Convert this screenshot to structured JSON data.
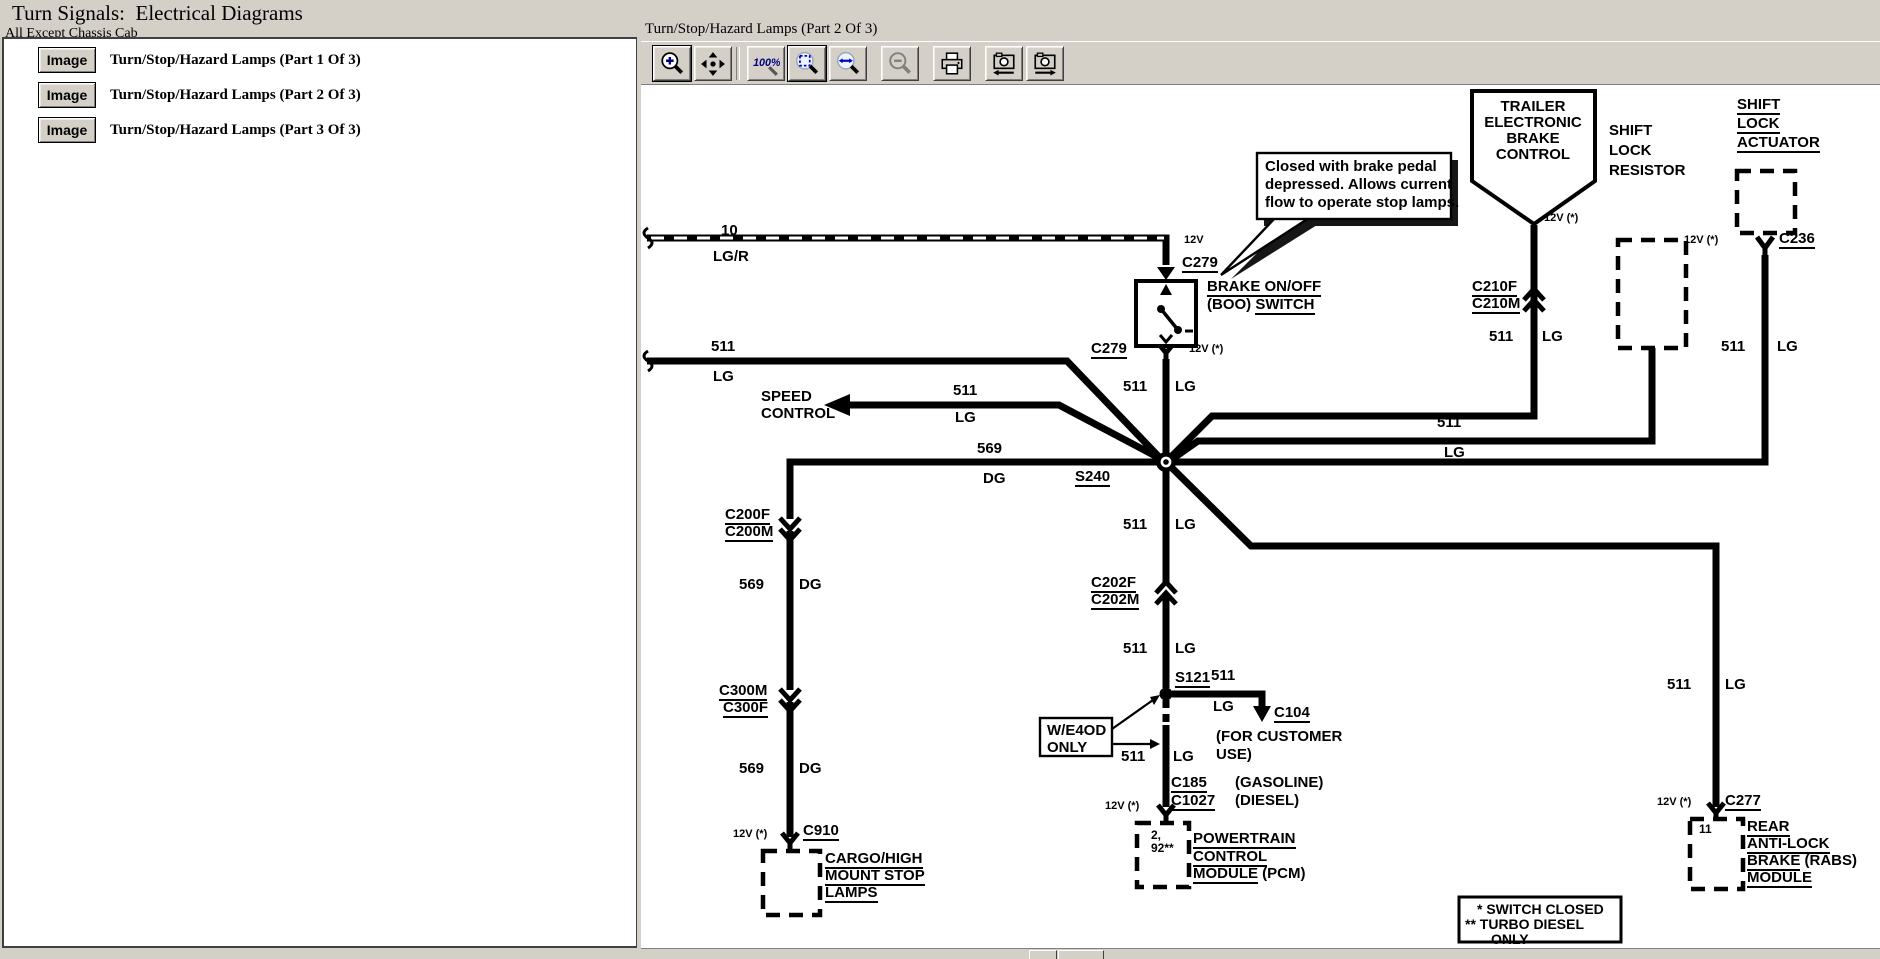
{
  "header": {
    "title": "Turn Signals:  Electrical Diagrams",
    "subtitle": "All Except Chassis Cab",
    "diagram_title": "Turn/Stop/Hazard Lamps (Part 2 Of 3)"
  },
  "sidebar": {
    "button_label": "Image",
    "items": [
      "Turn/Stop/Hazard Lamps (Part 1 Of 3)",
      "Turn/Stop/Hazard Lamps (Part 2 Of 3)",
      "Turn/Stop/Hazard Lamps (Part 3 Of 3)"
    ]
  },
  "toolbar": {
    "zoom100_label": "100%",
    "accent_blue": "#000080",
    "chrome_gray": "#d4d0c8"
  },
  "diagram": {
    "labels": [
      {
        "x": 80,
        "y": 138,
        "s": [
          [
            "10",
            0
          ]
        ]
      },
      {
        "x": 72,
        "y": 164,
        "s": [
          [
            "LG/R",
            0
          ]
        ]
      },
      {
        "x": 543,
        "y": 150,
        "fs": 11,
        "s": [
          [
            "12V",
            0
          ]
        ]
      },
      {
        "x": 541,
        "y": 170,
        "s": [
          [
            "C279",
            1
          ]
        ]
      },
      {
        "x": 566,
        "y": 194,
        "s": [
          [
            "BRAKE ON/OFF",
            1
          ]
        ]
      },
      {
        "x": 566,
        "y": 212,
        "s": [
          [
            "(BOO) ",
            0
          ],
          [
            "SWITCH",
            1
          ]
        ]
      },
      {
        "x": 450,
        "y": 256,
        "s": [
          [
            "C279",
            1
          ]
        ]
      },
      {
        "x": 548,
        "y": 259,
        "fs": 11,
        "s": [
          [
            "12V (*)",
            0
          ]
        ]
      },
      {
        "x": 70,
        "y": 254,
        "s": [
          [
            "511",
            0
          ]
        ]
      },
      {
        "x": 72,
        "y": 284,
        "s": [
          [
            "LG",
            0
          ]
        ]
      },
      {
        "x": 120,
        "y": 304,
        "s": [
          [
            "SPEED",
            0
          ]
        ]
      },
      {
        "x": 120,
        "y": 321,
        "s": [
          [
            "CONTROL",
            0
          ]
        ]
      },
      {
        "x": 312,
        "y": 298,
        "s": [
          [
            "511",
            0
          ]
        ]
      },
      {
        "x": 314,
        "y": 325,
        "s": [
          [
            "LG",
            0
          ]
        ]
      },
      {
        "x": 336,
        "y": 356,
        "s": [
          [
            "569",
            0
          ]
        ]
      },
      {
        "x": 342,
        "y": 386,
        "s": [
          [
            "DG",
            0
          ]
        ]
      },
      {
        "x": 434,
        "y": 384,
        "s": [
          [
            "S240",
            1
          ]
        ]
      },
      {
        "x": 482,
        "y": 294,
        "s": [
          [
            "511",
            0
          ]
        ]
      },
      {
        "x": 534,
        "y": 294,
        "s": [
          [
            "LG",
            0
          ]
        ]
      },
      {
        "x": 482,
        "y": 432,
        "s": [
          [
            "511",
            0
          ]
        ]
      },
      {
        "x": 534,
        "y": 432,
        "s": [
          [
            "LG",
            0
          ]
        ]
      },
      {
        "x": 450,
        "y": 490,
        "s": [
          [
            "C202F",
            1
          ]
        ]
      },
      {
        "x": 450,
        "y": 507,
        "s": [
          [
            "C202M",
            1
          ]
        ]
      },
      {
        "x": 482,
        "y": 556,
        "s": [
          [
            "511",
            0
          ]
        ]
      },
      {
        "x": 534,
        "y": 556,
        "s": [
          [
            "LG",
            0
          ]
        ]
      },
      {
        "x": 534,
        "y": 585,
        "s": [
          [
            "S121",
            1
          ]
        ]
      },
      {
        "x": 570,
        "y": 583,
        "s": [
          [
            "511",
            0
          ]
        ]
      },
      {
        "x": 572,
        "y": 614,
        "s": [
          [
            "LG",
            0
          ]
        ]
      },
      {
        "x": 633,
        "y": 620,
        "s": [
          [
            "C104",
            1
          ]
        ]
      },
      {
        "x": 575,
        "y": 644,
        "s": [
          [
            "(FOR CUSTOMER",
            0
          ]
        ]
      },
      {
        "x": 575,
        "y": 662,
        "s": [
          [
            "USE)",
            0
          ]
        ]
      },
      {
        "x": 406,
        "y": 638,
        "s": [
          [
            "W/E4OD",
            0
          ]
        ]
      },
      {
        "x": 406,
        "y": 655,
        "s": [
          [
            "ONLY",
            0
          ]
        ]
      },
      {
        "x": 480,
        "y": 664,
        "s": [
          [
            "511",
            0
          ]
        ]
      },
      {
        "x": 532,
        "y": 664,
        "s": [
          [
            "LG",
            0
          ]
        ]
      },
      {
        "x": 530,
        "y": 690,
        "s": [
          [
            "C185",
            1
          ]
        ]
      },
      {
        "x": 594,
        "y": 690,
        "s": [
          [
            "(GASOLINE)",
            0
          ]
        ]
      },
      {
        "x": 530,
        "y": 708,
        "s": [
          [
            "C1027",
            1
          ]
        ]
      },
      {
        "x": 594,
        "y": 708,
        "s": [
          [
            "(DIESEL)",
            0
          ]
        ]
      },
      {
        "x": 464,
        "y": 716,
        "fs": 11,
        "s": [
          [
            "12V (*)",
            0
          ]
        ]
      },
      {
        "x": 510,
        "y": 744,
        "fs": 12,
        "s": [
          [
            "2,",
            0
          ]
        ]
      },
      {
        "x": 510,
        "y": 757,
        "fs": 12,
        "s": [
          [
            "92**",
            0
          ]
        ]
      },
      {
        "x": 552,
        "y": 746,
        "s": [
          [
            "POWERTRAIN",
            1
          ]
        ]
      },
      {
        "x": 552,
        "y": 764,
        "s": [
          [
            "CONTROL",
            1
          ]
        ]
      },
      {
        "x": 552,
        "y": 781,
        "s": [
          [
            "MODULE",
            1
          ],
          [
            " (PCM)",
            0
          ]
        ]
      },
      {
        "x": 84,
        "y": 422,
        "s": [
          [
            "C200F",
            1
          ]
        ]
      },
      {
        "x": 84,
        "y": 439,
        "s": [
          [
            "C200M",
            1
          ]
        ]
      },
      {
        "x": 98,
        "y": 492,
        "s": [
          [
            "569",
            0
          ]
        ]
      },
      {
        "x": 158,
        "y": 492,
        "s": [
          [
            "DG",
            0
          ]
        ]
      },
      {
        "x": 78,
        "y": 598,
        "s": [
          [
            "C300M",
            1
          ]
        ]
      },
      {
        "x": 82,
        "y": 615,
        "s": [
          [
            "C300F",
            1
          ]
        ]
      },
      {
        "x": 98,
        "y": 676,
        "s": [
          [
            "569",
            0
          ]
        ]
      },
      {
        "x": 158,
        "y": 676,
        "s": [
          [
            "DG",
            0
          ]
        ]
      },
      {
        "x": 92,
        "y": 744,
        "fs": 11,
        "s": [
          [
            "12V (*)",
            0
          ]
        ]
      },
      {
        "x": 162,
        "y": 738,
        "s": [
          [
            "C910",
            1
          ]
        ]
      },
      {
        "x": 184,
        "y": 766,
        "s": [
          [
            "CARGO/HIGH",
            1
          ]
        ]
      },
      {
        "x": 184,
        "y": 783,
        "s": [
          [
            "MOUNT STOP",
            1
          ]
        ]
      },
      {
        "x": 184,
        "y": 800,
        "s": [
          [
            "LAMPS",
            1
          ]
        ]
      },
      {
        "x": 892,
        "y": 14,
        "al": "c",
        "s": [
          [
            "TRAILER",
            0
          ]
        ]
      },
      {
        "x": 892,
        "y": 30,
        "al": "c",
        "s": [
          [
            "ELECTRONIC",
            0
          ]
        ]
      },
      {
        "x": 892,
        "y": 46,
        "al": "c",
        "s": [
          [
            "BRAKE",
            0
          ]
        ]
      },
      {
        "x": 892,
        "y": 62,
        "al": "c",
        "s": [
          [
            "CONTROL",
            0
          ]
        ]
      },
      {
        "x": 903,
        "y": 128,
        "fs": 11,
        "s": [
          [
            "12V (*)",
            0
          ]
        ]
      },
      {
        "x": 848,
        "y": 244,
        "s": [
          [
            "511",
            0
          ]
        ]
      },
      {
        "x": 901,
        "y": 244,
        "s": [
          [
            "LG",
            0
          ]
        ]
      },
      {
        "x": 831,
        "y": 194,
        "s": [
          [
            "C210F",
            1
          ]
        ]
      },
      {
        "x": 831,
        "y": 211,
        "s": [
          [
            "C210M",
            1
          ]
        ]
      },
      {
        "x": 968,
        "y": 38,
        "s": [
          [
            "SHIFT",
            0
          ]
        ]
      },
      {
        "x": 968,
        "y": 58,
        "s": [
          [
            "LOCK",
            0
          ]
        ]
      },
      {
        "x": 968,
        "y": 78,
        "s": [
          [
            "RESISTOR",
            0
          ]
        ]
      },
      {
        "x": 796,
        "y": 330,
        "s": [
          [
            "511",
            0
          ]
        ]
      },
      {
        "x": 803,
        "y": 360,
        "s": [
          [
            "LG",
            0
          ]
        ]
      },
      {
        "x": 1096,
        "y": 12,
        "s": [
          [
            "SHIFT",
            1
          ]
        ]
      },
      {
        "x": 1096,
        "y": 31,
        "s": [
          [
            "LOCK",
            1
          ]
        ]
      },
      {
        "x": 1096,
        "y": 50,
        "s": [
          [
            "ACTUATOR",
            1
          ]
        ]
      },
      {
        "x": 1043,
        "y": 150,
        "fs": 11,
        "s": [
          [
            "12V (*)",
            0
          ]
        ]
      },
      {
        "x": 1138,
        "y": 146,
        "s": [
          [
            "C236",
            1
          ]
        ]
      },
      {
        "x": 1080,
        "y": 254,
        "s": [
          [
            "511",
            0
          ]
        ]
      },
      {
        "x": 1136,
        "y": 254,
        "s": [
          [
            "LG",
            0
          ]
        ]
      },
      {
        "x": 1026,
        "y": 592,
        "s": [
          [
            "511",
            0
          ]
        ]
      },
      {
        "x": 1084,
        "y": 592,
        "s": [
          [
            "LG",
            0
          ]
        ]
      },
      {
        "x": 1016,
        "y": 712,
        "fs": 11,
        "s": [
          [
            "12V (*)",
            0
          ]
        ]
      },
      {
        "x": 1084,
        "y": 708,
        "s": [
          [
            "C277",
            1
          ]
        ]
      },
      {
        "x": 1058,
        "y": 738,
        "fs": 12,
        "s": [
          [
            "11",
            0
          ]
        ]
      },
      {
        "x": 1106,
        "y": 734,
        "s": [
          [
            "REAR",
            1
          ]
        ]
      },
      {
        "x": 1106,
        "y": 751,
        "s": [
          [
            "ANTI-LOCK",
            1
          ]
        ]
      },
      {
        "x": 1106,
        "y": 768,
        "s": [
          [
            "BRAKE",
            1
          ],
          [
            " (RABS)",
            0
          ]
        ]
      },
      {
        "x": 1106,
        "y": 785,
        "s": [
          [
            "MODULE",
            1
          ]
        ]
      },
      {
        "x": 624,
        "y": 74,
        "fw": 600,
        "s": [
          [
            "Closed with brake pedal",
            0
          ]
        ]
      },
      {
        "x": 624,
        "y": 92,
        "fw": 600,
        "s": [
          [
            "depressed. Allows current",
            0
          ]
        ]
      },
      {
        "x": 624,
        "y": 110,
        "fw": 600,
        "s": [
          [
            "flow to operate stop lamps.",
            0
          ]
        ]
      },
      {
        "x": 836,
        "y": 817,
        "fs": 14,
        "s": [
          [
            "* SWITCH CLOSED",
            0
          ]
        ]
      },
      {
        "x": 824,
        "y": 832,
        "fs": 14,
        "s": [
          [
            "** TURBO DIESEL",
            0
          ]
        ]
      },
      {
        "x": 850,
        "y": 847,
        "fs": 14,
        "s": [
          [
            "ONLY",
            0
          ]
        ]
      }
    ]
  }
}
